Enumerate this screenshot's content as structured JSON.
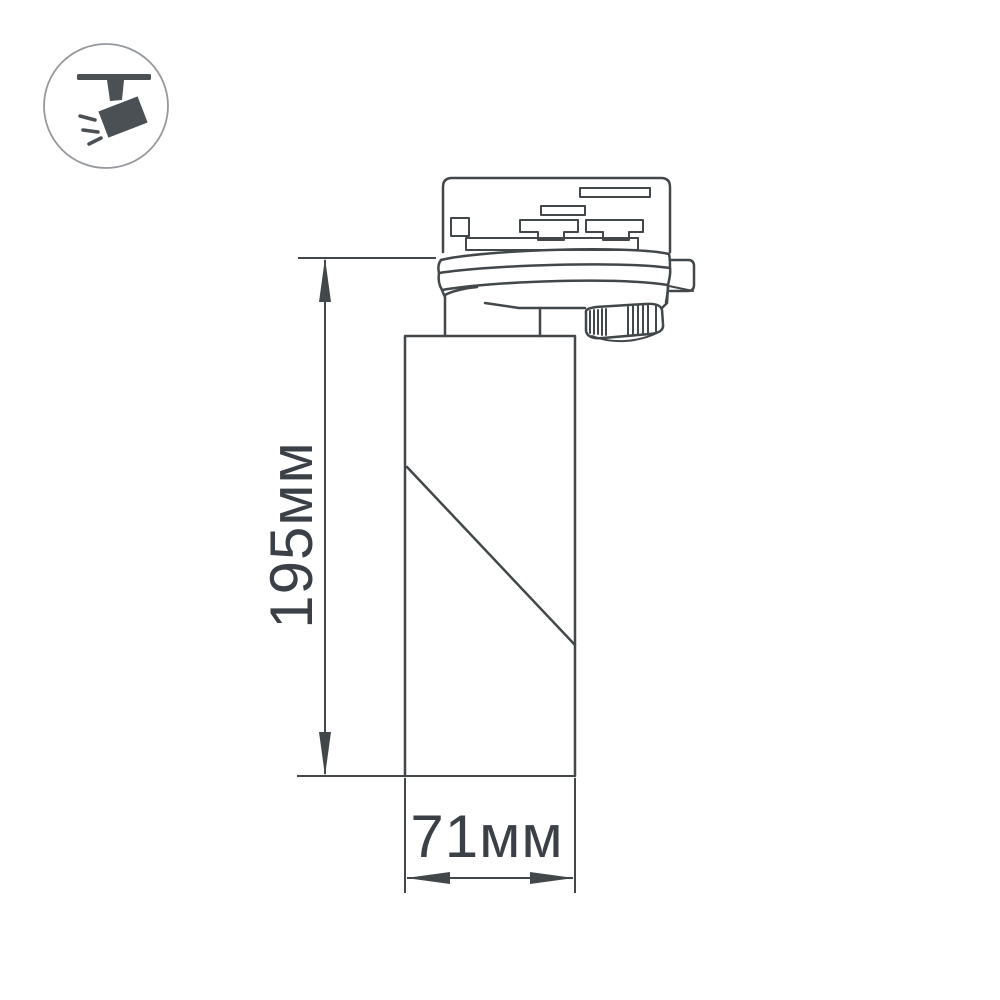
{
  "colors": {
    "line": "#42474a",
    "text": "#3b4046",
    "icon": "#4b5055",
    "circle": "#95999d",
    "background": "#ffffff"
  },
  "badge": {
    "icon": "ceiling-track-spotlight-icon"
  },
  "drawing": {
    "subject": "track-mounted cylindrical spotlight, side elevation",
    "dimensions": {
      "height": {
        "label": "195мм",
        "value": 195,
        "unit": "мм"
      },
      "width": {
        "label": "71мм",
        "value": 71,
        "unit": "мм"
      }
    }
  }
}
